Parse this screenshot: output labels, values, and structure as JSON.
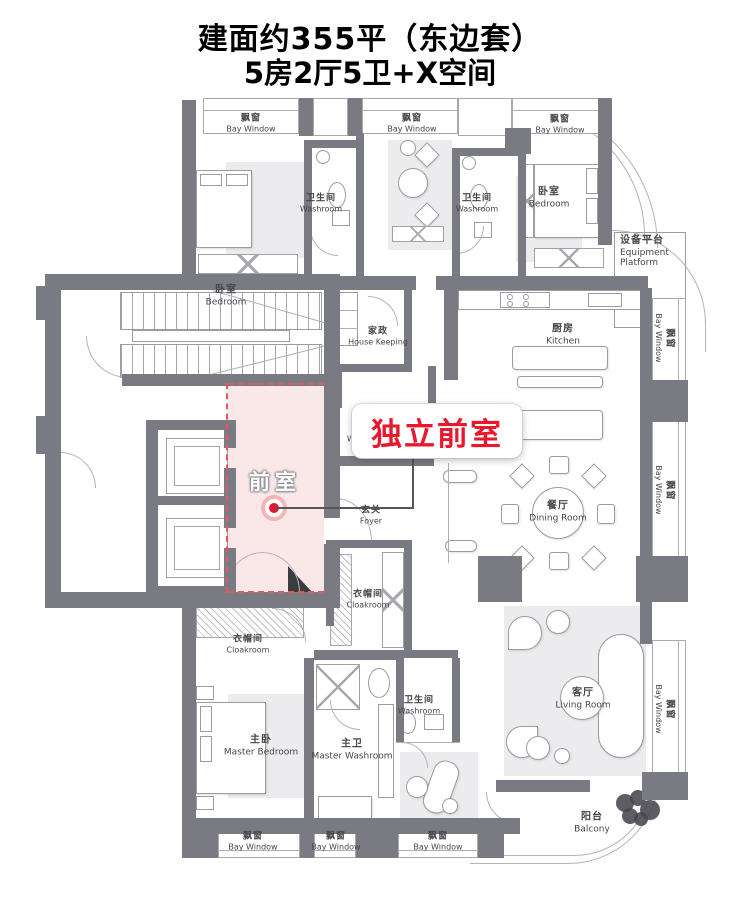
{
  "title": {
    "line1": "建面约355平（东边套）",
    "line2": "5房2厅5卫+X空间"
  },
  "highlight": {
    "label": "前室",
    "callout": "独立前室"
  },
  "colors": {
    "wall": "#7a7a82",
    "highlight_fill": "#fae8e8",
    "accent_red": "#e8192c",
    "dash_red": "#e25858"
  },
  "room_labels": [
    {
      "name": "bay-window-top-1",
      "zh": "飘窗",
      "en": "Bay Window",
      "x": 251,
      "y": 124,
      "small": true
    },
    {
      "name": "bay-window-top-2",
      "zh": "飘窗",
      "en": "Bay Window",
      "x": 412,
      "y": 124,
      "small": true
    },
    {
      "name": "bay-window-top-3",
      "zh": "飘窗",
      "en": "Bay Window",
      "x": 560,
      "y": 125,
      "small": true
    },
    {
      "name": "bedroom-top-left",
      "zh": "卧室",
      "en": "Bedroom",
      "x": 226,
      "y": 296
    },
    {
      "name": "washroom-top-left",
      "zh": "卫生间",
      "en": "Washroom",
      "x": 321,
      "y": 204,
      "small": true
    },
    {
      "name": "washroom-top-right",
      "zh": "卫生间",
      "en": "Washroom",
      "x": 477,
      "y": 204,
      "small": true
    },
    {
      "name": "bedroom-top-right",
      "zh": "卧室",
      "en": "Bedroom",
      "x": 549,
      "y": 198
    },
    {
      "name": "equipment-platform",
      "zh": "设备平台",
      "en": "Equipment Platform",
      "x": 620,
      "y": 252,
      "align": "left"
    },
    {
      "name": "house-keeping",
      "zh": "家政",
      "en": "House Keeping",
      "x": 378,
      "y": 337,
      "small": true
    },
    {
      "name": "kitchen",
      "zh": "厨房",
      "en": "Kitchen",
      "x": 563,
      "y": 335
    },
    {
      "name": "washroom-foyer",
      "zh": "卫生间",
      "en": "Washroom",
      "x": 368,
      "y": 434,
      "small": true,
      "under": true
    },
    {
      "name": "foyer",
      "zh": "玄关",
      "en": "Foyer",
      "x": 371,
      "y": 516,
      "small": true
    },
    {
      "name": "dining-room",
      "zh": "餐厅",
      "en": "Dining Room",
      "x": 558,
      "y": 512
    },
    {
      "name": "cloakroom-small",
      "zh": "衣帽间",
      "en": "Cloakroom",
      "x": 368,
      "y": 600,
      "small": true
    },
    {
      "name": "cloakroom",
      "zh": "衣帽间",
      "en": "Cloakroom",
      "x": 248,
      "y": 645,
      "small": true
    },
    {
      "name": "master-bedroom",
      "zh": "主卧",
      "en": "Master Bedroom",
      "x": 261,
      "y": 746
    },
    {
      "name": "master-washroom",
      "zh": "主卫",
      "en": "Master Washroom",
      "x": 352,
      "y": 750
    },
    {
      "name": "washroom-bottom",
      "zh": "卫生间",
      "en": "Washroom",
      "x": 419,
      "y": 706,
      "small": true
    },
    {
      "name": "living-room",
      "zh": "客厅",
      "en": "Living Room",
      "x": 583,
      "y": 699
    },
    {
      "name": "balcony",
      "zh": "阳台",
      "en": "Balcony",
      "x": 592,
      "y": 823
    },
    {
      "name": "bay-window-bottom-1",
      "zh": "飘窗",
      "en": "Bay Window",
      "x": 253,
      "y": 842,
      "small": true
    },
    {
      "name": "bay-window-bottom-2",
      "zh": "飘窗",
      "en": "Bay Window",
      "x": 336,
      "y": 842,
      "small": true
    },
    {
      "name": "bay-window-bottom-3",
      "zh": "飘窗",
      "en": "Bay Window",
      "x": 438,
      "y": 842,
      "small": true
    },
    {
      "name": "bay-window-right-1",
      "zh": "飘窗",
      "en": "Bay Window",
      "x": 664,
      "y": 338,
      "vertical": true,
      "small": true
    },
    {
      "name": "bay-window-right-2",
      "zh": "飘窗",
      "en": "Bay Window",
      "x": 664,
      "y": 490,
      "vertical": true,
      "small": true
    },
    {
      "name": "bay-window-right-3",
      "zh": "飘窗",
      "en": "Bay Window",
      "x": 664,
      "y": 709,
      "vertical": true,
      "small": true
    }
  ]
}
